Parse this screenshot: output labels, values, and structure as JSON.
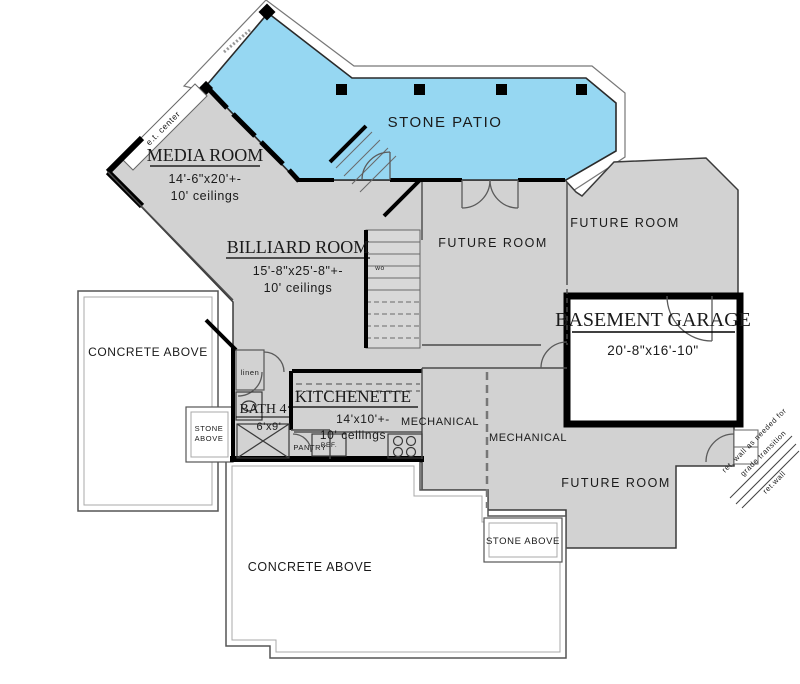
{
  "plan": {
    "patio": {
      "label": "STONE PATIO"
    },
    "media_room": {
      "name": "MEDIA ROOM",
      "dims": "14'-6\"x20'+-",
      "ceil": "10' ceilings"
    },
    "billiard_room": {
      "name": "BILLIARD ROOM",
      "dims": "15'-8\"x25'-8\"+-",
      "ceil": "10' ceilings"
    },
    "kitchenette": {
      "name": "KITCHENETTE",
      "dims": "14'x10'+-",
      "ceil": "10' ceilings"
    },
    "bath4": {
      "name": "BATH 4",
      "dims": "6'x9'"
    },
    "garage": {
      "name": "BASEMENT GARAGE",
      "dims": "20'-8\"x16'-10\""
    },
    "future_room": "FUTURE ROOM",
    "mechanical": "MECHANICAL",
    "concrete_above": "CONCRETE ABOVE",
    "stone_above": "STONE ABOVE",
    "stone_above_l1": "STONE",
    "stone_above_l2": "ABOVE",
    "pantry": "PANTRY",
    "linen": "linen",
    "ref": "REF.",
    "wo": "wo",
    "et_center": "e.t. center",
    "ret_wall_note1": "ret. wall as needed for",
    "ret_wall_note2": "grade transition",
    "ret_wall": "ret.wall"
  },
  "colors": {
    "patio_fill": "#96d7f2",
    "floor_fill": "#d2d2d2",
    "wall": "#000000"
  }
}
